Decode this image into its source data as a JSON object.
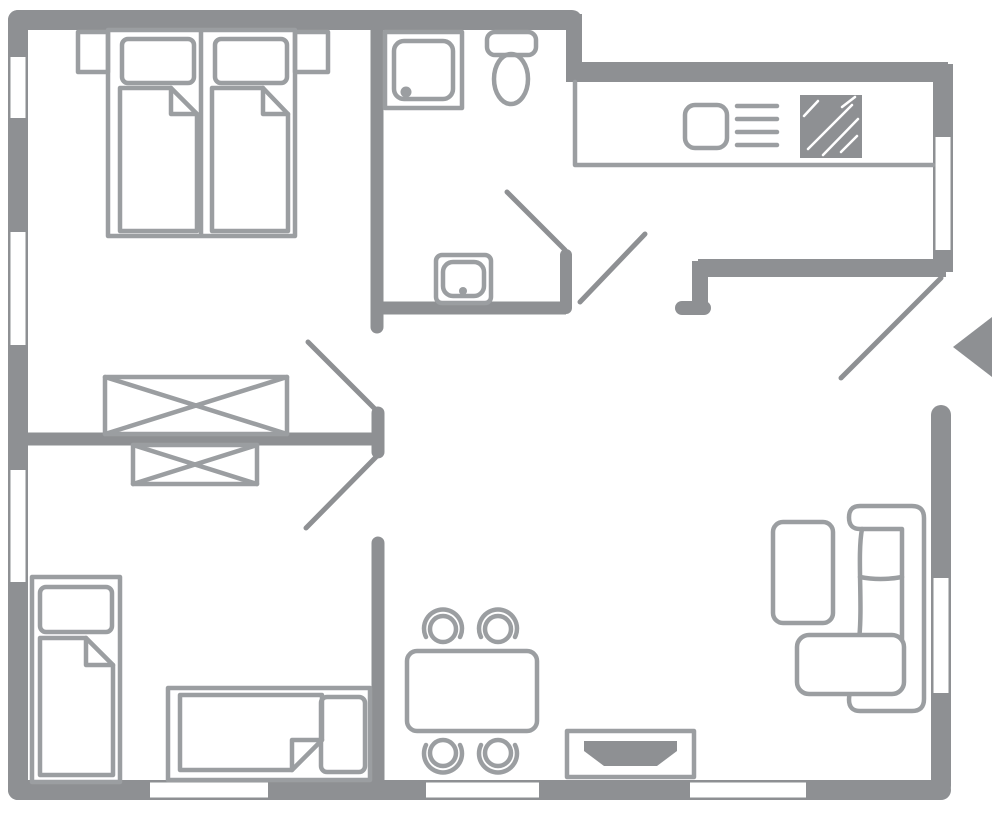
{
  "palette": {
    "background": "#ffffff",
    "wall": "#8e9093",
    "furniture": "#9b9ea1"
  },
  "plan": {
    "type": "apartment-floor-plan",
    "rooms": [
      {
        "name": "bedroom-top-left",
        "items": [
          "double-bed",
          "pillow-left",
          "pillow-right",
          "duvet-left",
          "duvet-right",
          "nightstand-left",
          "nightstand-right",
          "wardrobe-large-crossed"
        ]
      },
      {
        "name": "bathroom",
        "items": [
          "shower",
          "toilet",
          "washbasin"
        ]
      },
      {
        "name": "kitchen",
        "items": [
          "counter",
          "kitchen-sink",
          "cooktop-vent-lines",
          "stove-hatched-square"
        ]
      },
      {
        "name": "bedroom-bottom-left",
        "items": [
          "single-bed-vertical",
          "single-bed-horizontal",
          "wardrobe-small-crossed"
        ]
      },
      {
        "name": "dining-area",
        "items": [
          "dining-table",
          "chair-1",
          "chair-2",
          "chair-3",
          "chair-4",
          "tv-sideboard"
        ]
      },
      {
        "name": "living-area",
        "items": [
          "sofa",
          "ottoman",
          "coffee-table"
        ]
      }
    ],
    "windows_count": 8,
    "door_leaves_count": 5,
    "entrance": {
      "side": "right",
      "arrow_direction": "left"
    }
  }
}
